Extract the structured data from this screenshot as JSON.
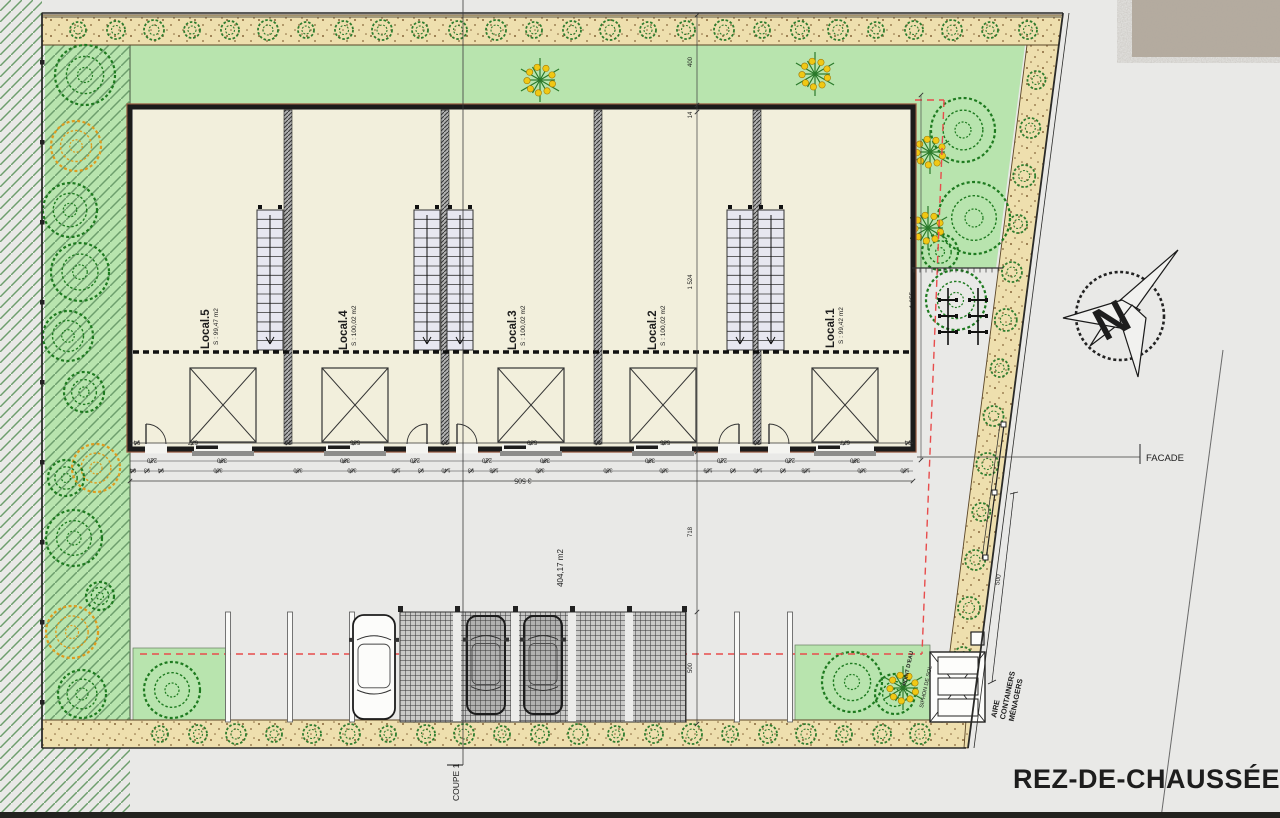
{
  "plan": {
    "title": "REZ-DE-CHAUSSÉE",
    "north_label": "N",
    "facade_label": "FACADE",
    "section_label": "COUPE 1",
    "courtyard_area_label": "404,17 m2",
    "containers_area_label_lines": [
      "AIRE",
      "CONTAINERS",
      "MÉNAGERS"
    ],
    "water_point_label": "POINT D'EAU",
    "floor_drain_label": "SIPHON DE SOL"
  },
  "units": [
    {
      "name": "Local.5",
      "area": "S : 99,47 m2"
    },
    {
      "name": "Local.4",
      "area": "S : 100,02 m2"
    },
    {
      "name": "Local.3",
      "area": "S : 100,02 m2"
    },
    {
      "name": "Local.2",
      "area": "S : 100,02 m2"
    },
    {
      "name": "Local.1",
      "area": "S : 99,42 m2"
    }
  ],
  "dimensions": {
    "overall_width": "3 505",
    "vertical_chain": [
      "400",
      "14",
      "1 524",
      "718",
      "500"
    ],
    "right_side_height": "1 655",
    "fence_length": "500",
    "facade_chain": [
      "94",
      "677",
      "20",
      "585",
      "20",
      "589",
      "20",
      "585",
      "20",
      "677",
      "94"
    ],
    "door_row": [
      "210",
      "390",
      "390",
      "210",
      "210",
      "390",
      "390",
      "210",
      "210",
      "390"
    ],
    "detail_row": [
      "84",
      "93",
      "94",
      "300",
      "350",
      "300",
      "109",
      "93",
      "140",
      "93",
      "108",
      "300",
      "350",
      "300",
      "109",
      "93",
      "140",
      "93",
      "108",
      "300",
      "130"
    ]
  },
  "colors": {
    "background": "#e9e9e7",
    "lawn": "#b8e4ae",
    "sand": "#eedfae",
    "hatch_line": "#6d9e6d",
    "building_fill": "#f2efdc",
    "wall": "#1b1b1b",
    "red_axis": "#e84c4c",
    "tree_green": "#1d7a1f",
    "tree_orange": "#de9b1e"
  }
}
